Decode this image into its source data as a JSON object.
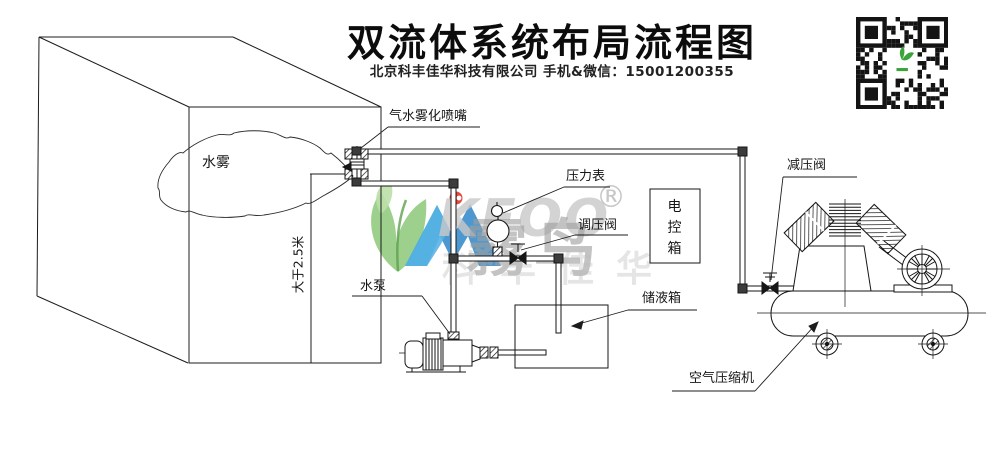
{
  "header": {
    "title": "双流体系统布局流程图",
    "subtitle": "北京科丰佳华科技有限公司 手机&微信：15001200355"
  },
  "diagram": {
    "mist_label": "水雾",
    "dimension_label": "大于2.5米",
    "nozzle_label": "气水雾化喷嘴",
    "pressure_gauge_label": "压力表",
    "regulating_valve_label": "调压阀",
    "control_box_label": "电控箱",
    "reducing_valve_label": "减压阀",
    "water_pump_label": "水泵",
    "storage_tank_label": "储液箱",
    "air_compressor_label": "空气压缩机"
  },
  "watermark": {
    "brand_en": "KEOO",
    "brand_cn": "霧鸟",
    "registered_mark": "®",
    "company_name": "科丰佳华",
    "colors": {
      "leaf_green": "#8cc878",
      "leaf_light": "#bcdfa8",
      "logo_blue": "#2e86c8",
      "logo_blue_light": "#57b4e3",
      "accent_red": "#e63229",
      "gray": "#b5b5b5"
    }
  },
  "qr_code": {
    "icon": "qr-code",
    "center_icon": "green-sprout-logo",
    "module_color": "#141414"
  }
}
